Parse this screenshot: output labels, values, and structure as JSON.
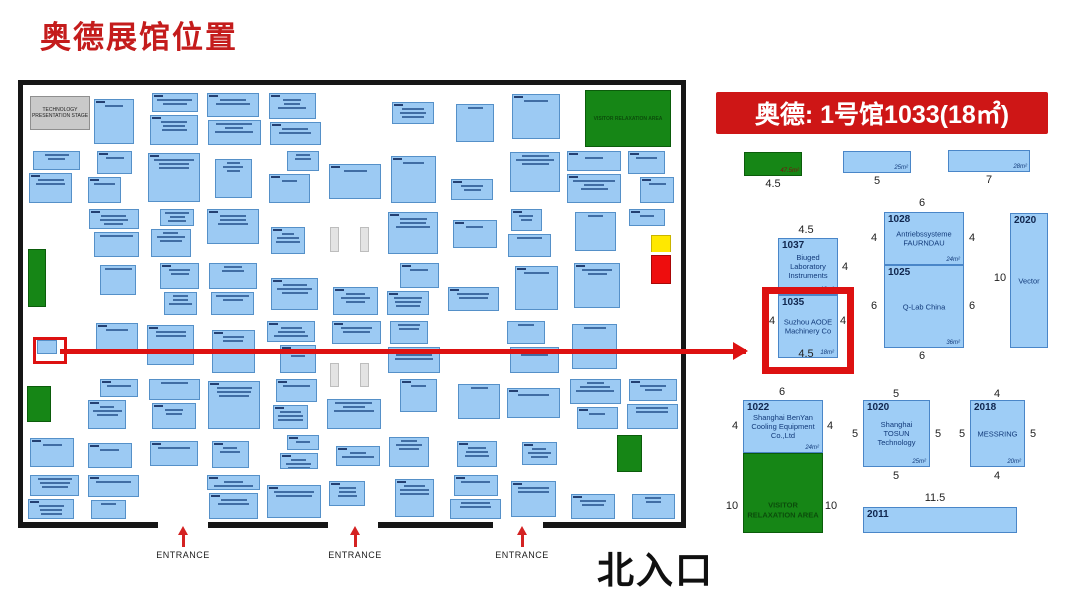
{
  "page": {
    "title": "奥德展馆位置"
  },
  "colors": {
    "accent_red": "#ce1616",
    "booth_blue": "#9ecdf6",
    "booth_border": "#4a86c8",
    "area_green": "#168616",
    "alert_yellow": "#ffe800",
    "alert_red": "#ee0d0d"
  },
  "floorplan": {
    "north_entrance_label": "北入口",
    "entrances": [
      {
        "label": "ENTRANCE",
        "x": 183
      },
      {
        "label": "ENTRANCE",
        "x": 355
      },
      {
        "label": "ENTRANCE",
        "x": 522
      }
    ],
    "areas": [
      {
        "name": "technology-presentation-stage",
        "type": "stage",
        "label": "TECHNOLOGY PRESENTATION STAGE",
        "x": 7,
        "y": 11,
        "w": 60,
        "h": 34
      },
      {
        "name": "visitor-relaxation-area",
        "type": "green",
        "label": "VISITOR RELAXATION AREA",
        "x": 562,
        "y": 5,
        "w": 86,
        "h": 57
      },
      {
        "name": "green-area-left-upper",
        "type": "green",
        "label": "",
        "x": 5,
        "y": 164,
        "w": 18,
        "h": 58
      },
      {
        "name": "green-area-left-lower",
        "type": "green",
        "label": "",
        "x": 4,
        "y": 301,
        "w": 24,
        "h": 36
      },
      {
        "name": "green-area-mid-right",
        "type": "green",
        "label": "",
        "x": 594,
        "y": 350,
        "w": 25,
        "h": 37
      },
      {
        "name": "yellow-booth",
        "type": "yellow",
        "label": "",
        "x": 628,
        "y": 150,
        "w": 20,
        "h": 20
      },
      {
        "name": "red-booth",
        "type": "red",
        "label": "",
        "x": 628,
        "y": 170,
        "w": 20,
        "h": 29
      },
      {
        "name": "pillar",
        "type": "pillar",
        "label": "",
        "x": 307,
        "y": 142,
        "w": 9,
        "h": 25
      },
      {
        "name": "pillar",
        "type": "pillar",
        "label": "",
        "x": 337,
        "y": 142,
        "w": 9,
        "h": 25
      },
      {
        "name": "pillar",
        "type": "pillar",
        "label": "",
        "x": 307,
        "y": 278,
        "w": 9,
        "h": 24
      },
      {
        "name": "pillar",
        "type": "pillar",
        "label": "",
        "x": 337,
        "y": 278,
        "w": 9,
        "h": 24
      }
    ],
    "highlight_box": {
      "x": 10,
      "y": 252,
      "w": 28,
      "h": 21
    },
    "highlight_booth": {
      "x": 14,
      "y": 255,
      "w": 20,
      "h": 14
    },
    "bottom_border_segments": [
      [
        0,
        135
      ],
      [
        185,
        305
      ],
      [
        355,
        470
      ],
      [
        520,
        658
      ]
    ]
  },
  "detail": {
    "banner_label": "奥德: 1号馆1033(18㎡)",
    "size_bars": [
      {
        "dim": "4.5",
        "area": "47.5m²",
        "color": "green",
        "x": 744,
        "y": 152,
        "w": 58,
        "h": 24
      },
      {
        "dim": "5",
        "area": "25m²",
        "color": "blue",
        "x": 843,
        "y": 151,
        "w": 68,
        "h": 22
      },
      {
        "dim": "7",
        "area": "28m²",
        "color": "blue",
        "x": 948,
        "y": 150,
        "w": 82,
        "h": 22
      }
    ],
    "booths": [
      {
        "id": "1037",
        "name": "Biuged Laboratory Instruments",
        "area": "18m²",
        "color": "blue",
        "x": 778,
        "y": 238,
        "w": 60,
        "h": 57
      },
      {
        "id": "1035",
        "name": "Suzhou AODE Machinery Co",
        "area": "18m²",
        "color": "blue",
        "x": 778,
        "y": 295,
        "w": 60,
        "h": 63,
        "highlight": true
      },
      {
        "id": "1028",
        "name": "Antriebssysteme FAURNDAU",
        "area": "24m²",
        "color": "blue",
        "x": 884,
        "y": 212,
        "w": 80,
        "h": 53
      },
      {
        "id": "1025",
        "name": "Q-Lab China",
        "area": "36m²",
        "color": "blue",
        "x": 884,
        "y": 265,
        "w": 80,
        "h": 83
      },
      {
        "id": "2020",
        "name": "Vector",
        "area": "",
        "color": "blue",
        "x": 1010,
        "y": 213,
        "w": 38,
        "h": 135
      },
      {
        "id": "1022",
        "name": "Shanghai BenYan Cooling Equipment Co.,Ltd",
        "area": "24m²",
        "color": "blue",
        "x": 743,
        "y": 400,
        "w": 80,
        "h": 53
      },
      {
        "id": "",
        "name": "VISITOR RELAXATION AREA",
        "area": "",
        "color": "green",
        "x": 743,
        "y": 453,
        "w": 80,
        "h": 80
      },
      {
        "id": "1020",
        "name": "Shanghai TOSUN Technology",
        "area": "25m²",
        "color": "blue",
        "x": 863,
        "y": 400,
        "w": 67,
        "h": 67
      },
      {
        "id": "2018",
        "name": "MESSRING",
        "area": "20m²",
        "color": "blue",
        "x": 970,
        "y": 400,
        "w": 55,
        "h": 67
      },
      {
        "id": "2011",
        "name": "",
        "area": "",
        "color": "blue",
        "x": 863,
        "y": 507,
        "w": 154,
        "h": 26
      }
    ],
    "dims": [
      {
        "text": "4.5",
        "x": 806,
        "y": 224
      },
      {
        "text": "4",
        "x": 845,
        "y": 261
      },
      {
        "text": "4",
        "x": 772,
        "y": 315
      },
      {
        "text": "4",
        "x": 843,
        "y": 315
      },
      {
        "text": "4.5",
        "x": 806,
        "y": 348
      },
      {
        "text": "6",
        "x": 922,
        "y": 197
      },
      {
        "text": "4",
        "x": 874,
        "y": 232
      },
      {
        "text": "4",
        "x": 972,
        "y": 232
      },
      {
        "text": "6",
        "x": 874,
        "y": 300
      },
      {
        "text": "6",
        "x": 972,
        "y": 300
      },
      {
        "text": "6",
        "x": 922,
        "y": 350
      },
      {
        "text": "10",
        "x": 1000,
        "y": 272
      },
      {
        "text": "6",
        "x": 782,
        "y": 386
      },
      {
        "text": "4",
        "x": 735,
        "y": 420
      },
      {
        "text": "4",
        "x": 830,
        "y": 420
      },
      {
        "text": "10",
        "x": 732,
        "y": 500
      },
      {
        "text": "10",
        "x": 831,
        "y": 500
      },
      {
        "text": "5",
        "x": 896,
        "y": 388
      },
      {
        "text": "5",
        "x": 855,
        "y": 428
      },
      {
        "text": "5",
        "x": 938,
        "y": 428
      },
      {
        "text": "5",
        "x": 896,
        "y": 470
      },
      {
        "text": "4",
        "x": 997,
        "y": 388
      },
      {
        "text": "5",
        "x": 962,
        "y": 428
      },
      {
        "text": "5",
        "x": 1033,
        "y": 428
      },
      {
        "text": "4",
        "x": 997,
        "y": 470
      },
      {
        "text": "11.5",
        "x": 935,
        "y": 492
      }
    ]
  }
}
